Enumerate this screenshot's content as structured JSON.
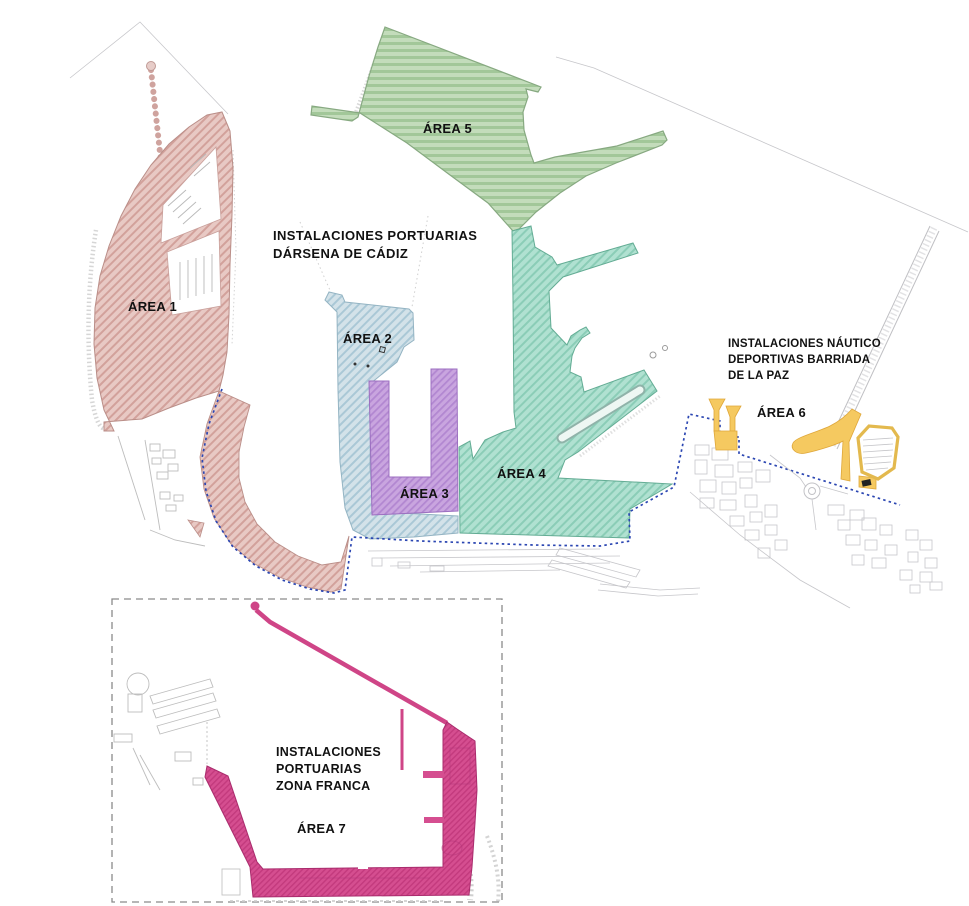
{
  "map": {
    "background": "#ffffff",
    "text_color": "#111111",
    "port_limit_dash_color": "#2b46b2",
    "zona_franca_box_color": "#8a8a8a",
    "sections": [
      {
        "name": "darsena-de-cadiz-port-installations",
        "label_lines": [
          "INSTALACIONES  PORTUARIAS",
          "DÁRSENA DE CÁDIZ"
        ],
        "areas_included": [
          "ÁREA 1",
          "ÁREA 2",
          "ÁREA 3",
          "ÁREA 4",
          "ÁREA 5"
        ]
      },
      {
        "name": "barriada-de-la-paz-nautical-sports-installations",
        "label_lines": [
          "INSTALACIONES  NÁUTICO",
          "DEPORTIVAS BARRIADA",
          "DE LA PAZ"
        ],
        "areas_included": [
          "ÁREA 6"
        ]
      },
      {
        "name": "zona-franca-port-installations",
        "label_lines": [
          "INSTALACIONES",
          "PORTUARIAS",
          "ZONA FRANCA"
        ],
        "areas_included": [
          "ÁREA 7"
        ]
      }
    ],
    "areas": [
      {
        "id": "area-1",
        "label": "ÁREA 1",
        "fill": "#e8c9c4",
        "hatch": "#d2a19b",
        "outline": "#ba8e88"
      },
      {
        "id": "area-2",
        "label": "ÁREA 2",
        "fill": "#d3e2e9",
        "hatch": "#aac8d6",
        "outline": "#94b4c3"
      },
      {
        "id": "area-3",
        "label": "ÁREA 3",
        "fill": "#c9a5df",
        "hatch": "#b287d1",
        "outline": "#9c6fc0"
      },
      {
        "id": "area-4",
        "label": "ÁREA 4",
        "fill": "#b0e1d1",
        "hatch": "#8bcdb7",
        "outline": "#63ac94"
      },
      {
        "id": "area-5",
        "label": "ÁREA 5",
        "fill": "#c3dcbb",
        "hatch": "#a2c799",
        "outline": "#87a981"
      },
      {
        "id": "area-6",
        "label": "ÁREA 6",
        "fill": "#f5c960",
        "hatch": "#f5c960",
        "outline": "#dfa73a"
      },
      {
        "id": "area-7",
        "label": "ÁREA 7",
        "fill": "#d54e90",
        "hatch": "#c33a7d",
        "outline": "#a92c6d"
      }
    ]
  }
}
